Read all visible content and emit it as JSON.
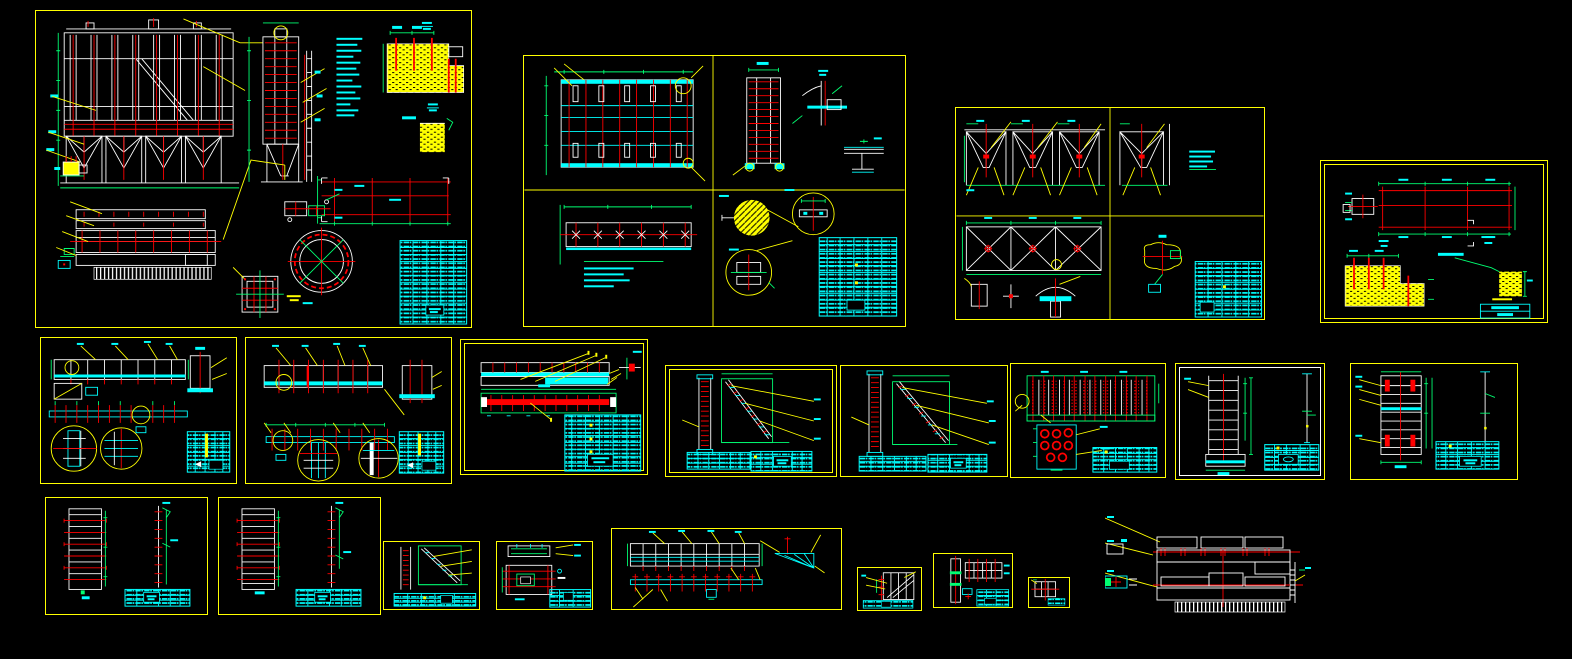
{
  "document": {
    "kind": "cad-drawing-workspace",
    "description": "AutoCAD-style model space showing 21 engineering drawing sheets of an electrostatic precipitator / dust collector steel structure",
    "sheet_count": 21,
    "visible_text_legible": false
  },
  "palette": {
    "background": "#000000",
    "sheet_border": "#FFFF00",
    "line_white": "#FFFFFF",
    "line_red": "#FF0000",
    "annotation_cyan": "#00FFFF",
    "dimension_green": "#00FF72",
    "leader_yellow": "#FFFF00",
    "concrete_hatch_fill": "#FFFF00"
  },
  "sheets": [
    {
      "id": "general-assembly"
    },
    {
      "id": "panel-and-column"
    },
    {
      "id": "hoppers-and-brace-frame"
    },
    {
      "id": "foundation-plan"
    },
    {
      "id": "girder-1"
    },
    {
      "id": "girder-2"
    },
    {
      "id": "cathode-beam"
    },
    {
      "id": "stair-1"
    },
    {
      "id": "stair-2"
    },
    {
      "id": "electrode-bank"
    },
    {
      "id": "ladder-1"
    },
    {
      "id": "ladder-2"
    },
    {
      "id": "louver-panel-1"
    },
    {
      "id": "louver-panel-2"
    },
    {
      "id": "stair-detail"
    },
    {
      "id": "beam-section"
    },
    {
      "id": "walkway-beam"
    },
    {
      "id": "brace-detail"
    },
    {
      "id": "column-detail"
    },
    {
      "id": "grid-detail"
    },
    {
      "id": "roof-plan"
    }
  ]
}
